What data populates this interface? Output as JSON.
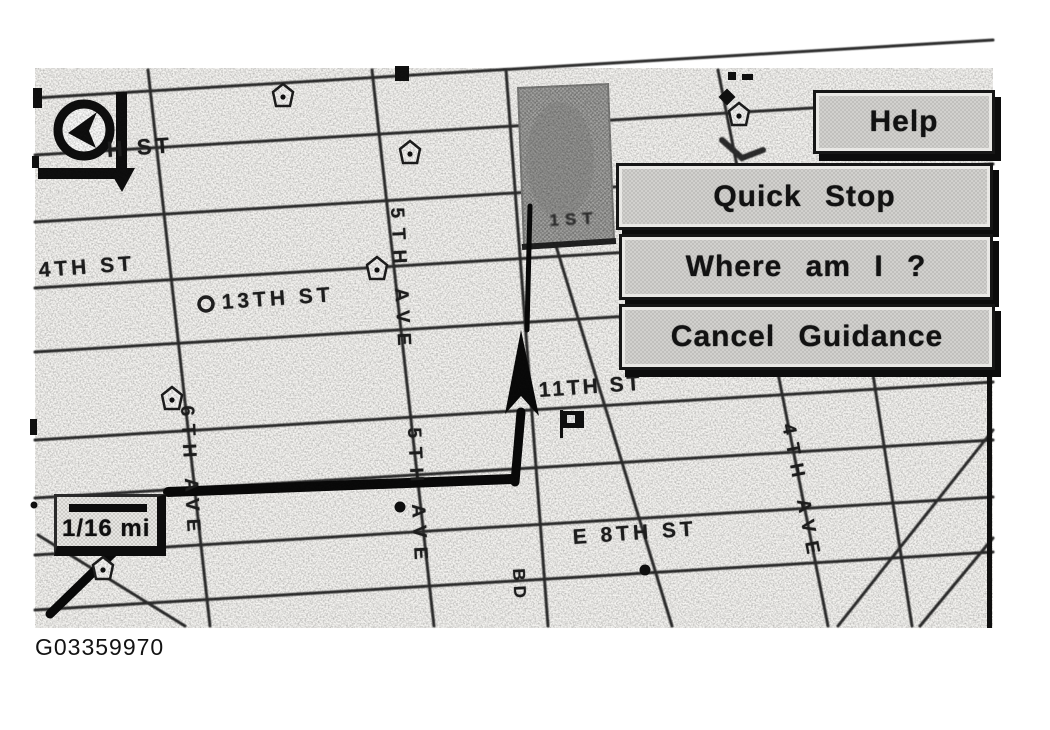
{
  "window": {
    "caption": "G03359970"
  },
  "menu": {
    "help": "Help",
    "quick_stop": "Quick Stop",
    "where_am_i": "Where am I ?",
    "cancel_guidance": "Cancel Guidance"
  },
  "map": {
    "scale": "1/16 mi",
    "labels": {
      "h_st": "H ST",
      "fourth_st": "4TH ST",
      "thirteenth_st": "13TH ST",
      "eleventh_st": "11TH ST",
      "e_eighth_st": "E 8TH ST",
      "fifth_ave_upper": "5TH AVE",
      "fifth_ave_lower": "5TH AVE",
      "sixth_ave": "6TH AVE",
      "fourth_ave": "4TH AVE",
      "bd_fragment": "BD",
      "first_fragment": "1ST"
    },
    "icons": {
      "compass": "compass-icon",
      "north_arrow": "north-arrow-icon",
      "poi_badge": "pentagon-badge-icon",
      "metro_circle": "circle-station-icon",
      "destination_flag": "flag-icon",
      "poi_dot": "poi-dot"
    },
    "colors": {
      "ink": "#161616",
      "map_bg": "#f4f3f0",
      "button_fill": "#c9c8c5",
      "park_block_fill": "#9b9b9b",
      "route": "#0a0a0a"
    }
  }
}
